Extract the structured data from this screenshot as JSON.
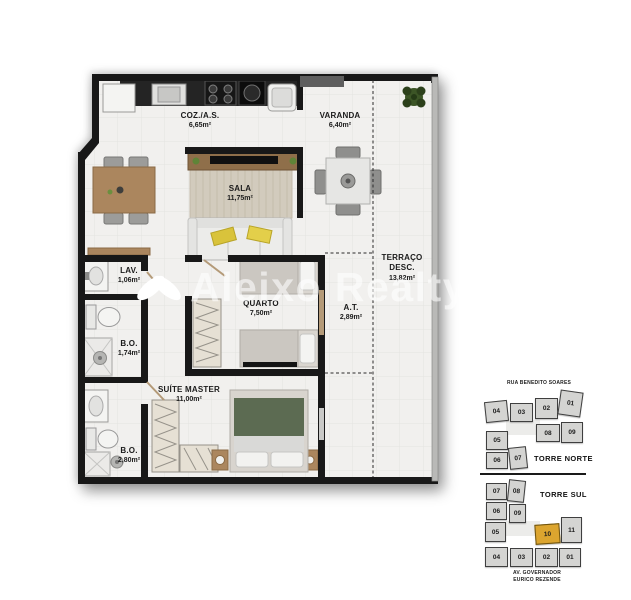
{
  "plan": {
    "watermark": "Aleixo Realty",
    "rooms": {
      "coz": {
        "label": "COZ./A.S.",
        "area": "6,65m²"
      },
      "varanda": {
        "label": "VARANDA",
        "area": "6,40m²"
      },
      "sala": {
        "label": "SALA",
        "area": "11,75m²"
      },
      "terraco": {
        "label_line1": "TERRAÇO",
        "label_line2": "DESC.",
        "area": "13,82m²"
      },
      "lav": {
        "label": "LAV.",
        "area": "1,06m²"
      },
      "bo_social": {
        "label": "B.O.",
        "area": "1,74m²"
      },
      "quarto": {
        "label": "QUARTO",
        "area": "7,50m²"
      },
      "at": {
        "label": "A.T.",
        "area": "2,89m²"
      },
      "suite": {
        "label": "SUÍTE MASTER",
        "area": "11,00m²"
      },
      "bo_suite": {
        "label": "B.O.",
        "area": "2,80m²"
      }
    }
  },
  "keyplan": {
    "street_top": "RUA BENEDITO SOARES",
    "street_bottom_line1": "AV. GOVERNADOR",
    "street_bottom_line2": "EURICO REZENDE",
    "highlighted_unit": "10",
    "highlight_color": "#dca52f",
    "torre_norte": {
      "label": "TORRE NORTE",
      "units": [
        "04",
        "03",
        "02",
        "01",
        "08",
        "09",
        "05",
        "06",
        "07"
      ]
    },
    "torre_sul": {
      "label": "TORRE SUL",
      "units": [
        "07",
        "08",
        "06",
        "09",
        "05",
        "10",
        "11",
        "04",
        "03",
        "02",
        "01"
      ]
    }
  },
  "colors": {
    "wall": "#1a1a1a",
    "floor": "#f1f0ee",
    "wood": "#ab865e",
    "unit_fill": "#d4d4d2",
    "unit_highlight": "#dca52f"
  }
}
